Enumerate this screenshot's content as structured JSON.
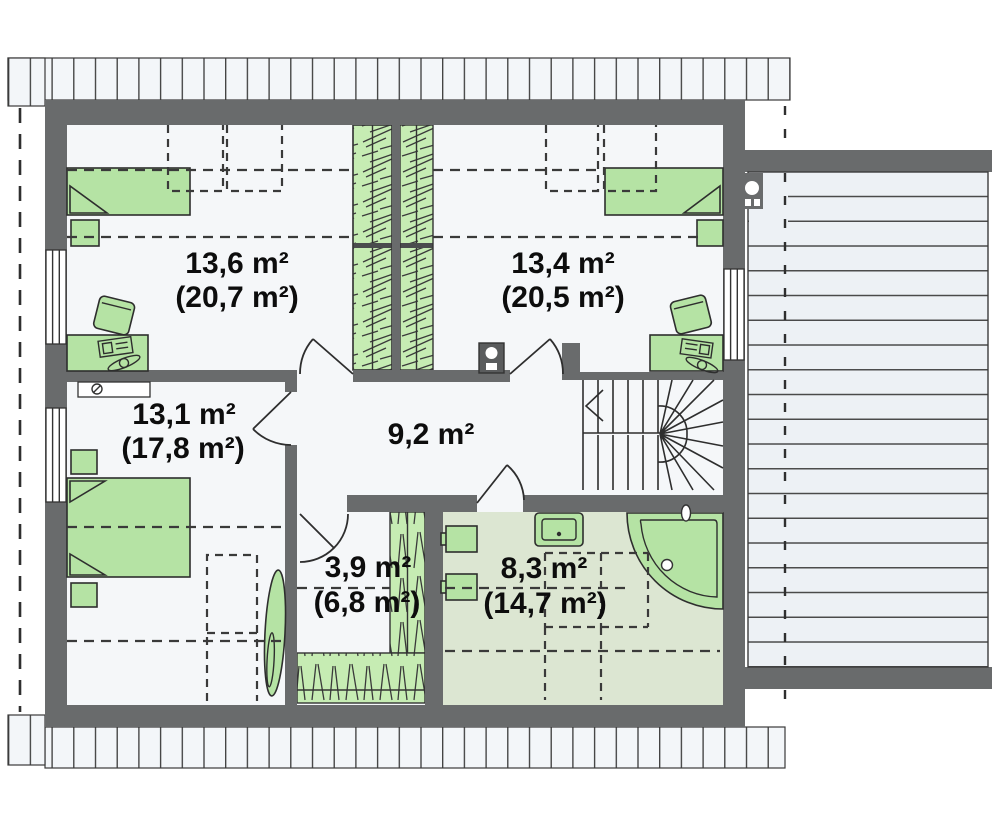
{
  "rooms": {
    "r136": {
      "area": "13,6 m²",
      "area_gross": "(20,7 m²)"
    },
    "r134": {
      "area": "13,4 m²",
      "area_gross": "(20,5 m²)"
    },
    "r131": {
      "area": "13,1 m²",
      "area_gross": "(17,8 m²)"
    },
    "hall": {
      "area": "9,2 m²"
    },
    "wardrobe_room": {
      "area": "3,9 m²",
      "area_gross": "(6,8 m²)"
    },
    "bathroom": {
      "area": "8,3 m²",
      "area_gross": "(14,7 m²)"
    }
  },
  "colors": {
    "wall": "#696b6c",
    "floor": "#f5f7f9",
    "bath_floor": "#dce6d2",
    "furniture": "#b5e3a4",
    "wardrobe": "#c6ecb3",
    "band": "#f3f6f9",
    "deck": "#edf1f5"
  }
}
